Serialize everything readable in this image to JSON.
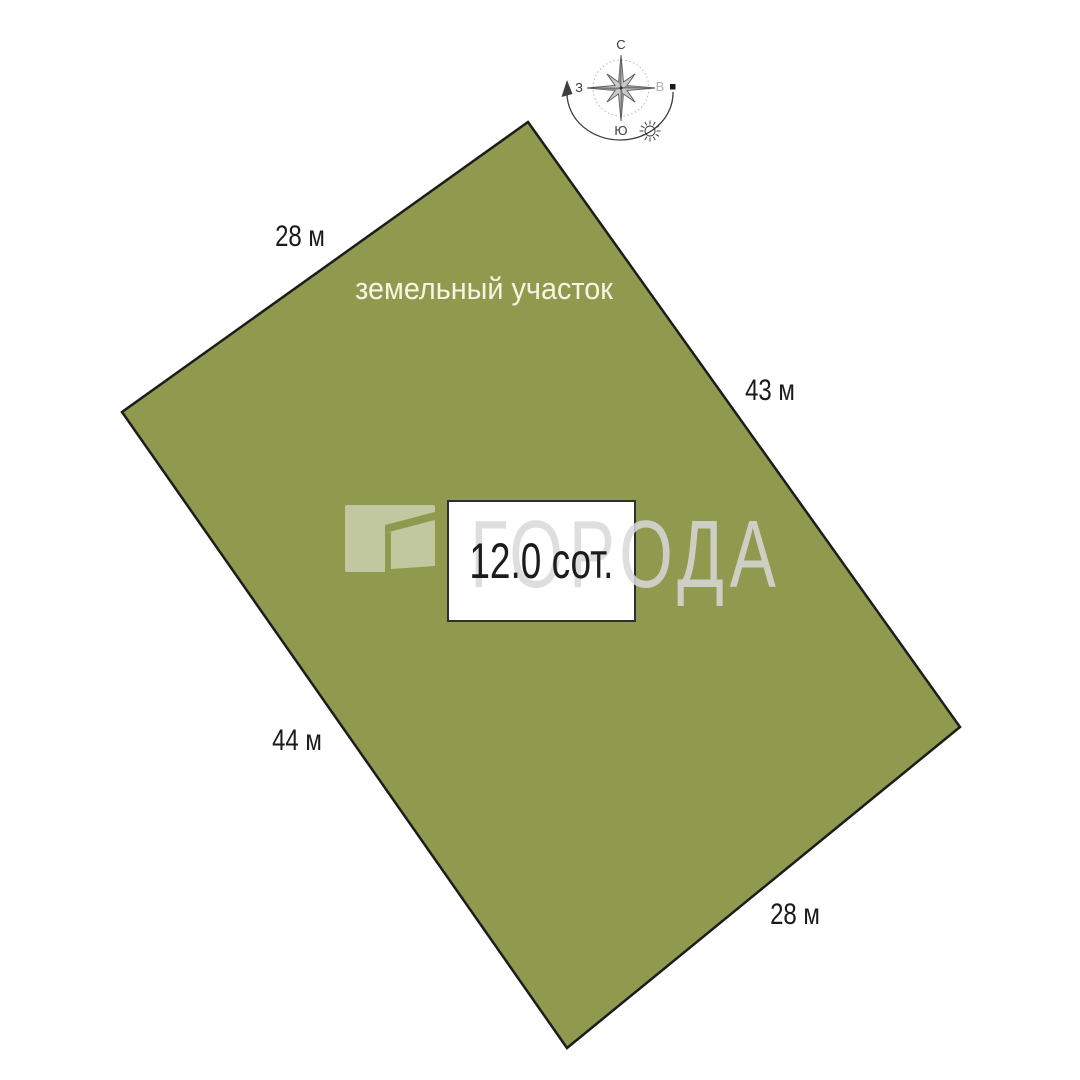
{
  "plot": {
    "name": "земельный участок",
    "area": "12.0 сот.",
    "fill_color": "#8f9a4f",
    "border_color": "#1c1c1c",
    "sides": [
      {
        "id": "top-left",
        "label": "28 м"
      },
      {
        "id": "right-top",
        "label": "43 м"
      },
      {
        "id": "left-bottom",
        "label": "44 м"
      },
      {
        "id": "bottom-right",
        "label": "28 м"
      }
    ]
  },
  "compass": {
    "north": "С",
    "south": "Ю",
    "west": "З",
    "east": "В",
    "icons": {
      "rose": "compass-rose-icon",
      "sun": "sun-icon",
      "rotation_arrow": "rotation-arrow-icon",
      "east_marker": "square-marker-icon"
    }
  },
  "watermark": {
    "text": "ГОРОДА",
    "logo_icon": "goroda-logo-icon",
    "color": "#d9d9d9"
  },
  "colors": {
    "background": "#ffffff",
    "plot_fill": "#8f9a4f",
    "plot_border": "#1c1c1c",
    "dimension_text": "#1a1a1a",
    "plot_name_text": "#f6f4e2",
    "area_text": "#1c1c1c"
  }
}
